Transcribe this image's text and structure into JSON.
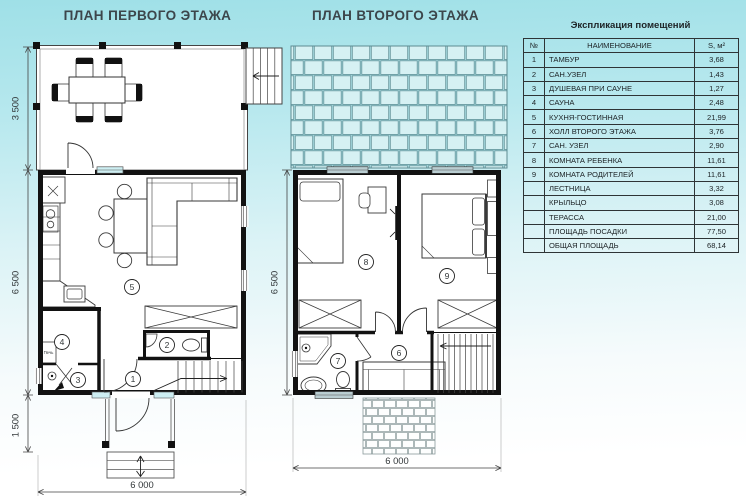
{
  "plan1": {
    "title": "ПЛАН ПЕРВОГО ЭТАЖА",
    "dims": {
      "terrace_depth": "3 500",
      "floor_depth": "6 500",
      "porch_depth": "1 500",
      "width": "6 000"
    },
    "rooms": {
      "r1": "1",
      "r2": "2",
      "r3": "3",
      "r4": "4",
      "r5": "5"
    },
    "labels": {
      "stove": "Печь"
    }
  },
  "plan2": {
    "title": "ПЛАН ВТОРОГО ЭТАЖА",
    "dims": {
      "floor_depth": "6 500",
      "width": "6 000"
    },
    "rooms": {
      "r6": "6",
      "r7": "7",
      "r8": "8",
      "r9": "9"
    }
  },
  "explication": {
    "title": "Экспликация помещений",
    "headers": {
      "num": "№",
      "name": "НАИМЕНОВАНИЕ",
      "area": "S, м²"
    },
    "rows": [
      {
        "num": "1",
        "name": "ТАМБУР",
        "area": "3,68"
      },
      {
        "num": "2",
        "name": "САН.УЗЕЛ",
        "area": "1,43"
      },
      {
        "num": "3",
        "name": "ДУШЕВАЯ ПРИ САУНЕ",
        "area": "1,27"
      },
      {
        "num": "4",
        "name": "САУНА",
        "area": "2,48"
      },
      {
        "num": "5",
        "name": "КУХНЯ-ГОСТИННАЯ",
        "area": "21,99"
      },
      {
        "num": "6",
        "name": "ХОЛЛ  ВТОРОГО ЭТАЖА",
        "area": "3,76"
      },
      {
        "num": "7",
        "name": "САН. УЗЕЛ",
        "area": "2,90"
      },
      {
        "num": "8",
        "name": "КОМНАТА РЕБЕНКА",
        "area": "11,61"
      },
      {
        "num": "9",
        "name": "КОМНАТА РОДИТЕЛЕЙ",
        "area": "11,61"
      },
      {
        "num": "",
        "name": "ЛЕСТНИЦА",
        "area": "3,32"
      },
      {
        "num": "",
        "name": "КРЫЛЬЦО",
        "area": "3,08"
      },
      {
        "num": "",
        "name": "ТЕРАССА",
        "area": "21,00"
      },
      {
        "num": "",
        "name": "ПЛОЩАДЬ ПОСАДКИ",
        "area": "77,50"
      },
      {
        "num": "",
        "name": "ОБЩАЯ ПЛОЩАДЬ",
        "area": "68,14"
      }
    ]
  },
  "colors": {
    "background_top": "#9fe0e7",
    "wall": "#121212",
    "roof_fill": "#d6f1f3",
    "glass": "#cdeef2"
  }
}
